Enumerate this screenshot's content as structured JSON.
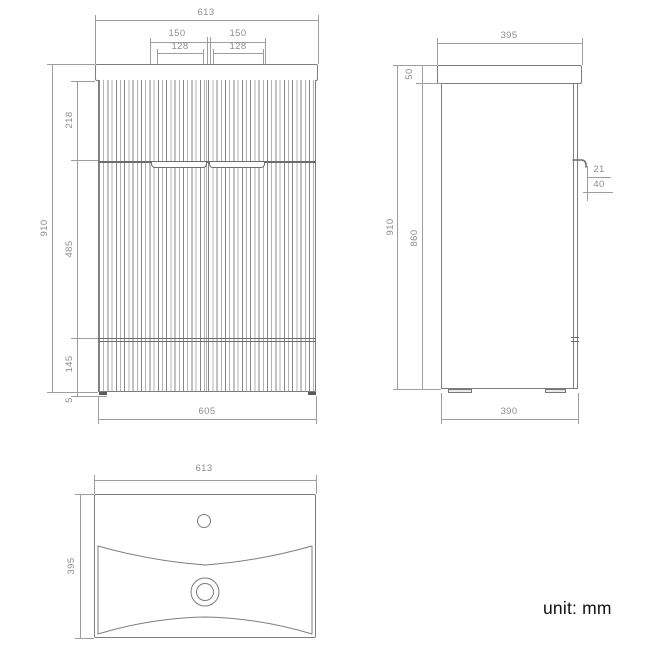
{
  "note": {
    "unit_label": "unit: mm"
  },
  "front_view": {
    "dims": {
      "overall_width": "613",
      "handle_span_left": "150",
      "handle_span_right": "150",
      "handle_width_left": "128",
      "handle_width_right": "128",
      "overall_height": "910",
      "top_section_height": "218",
      "middle_section_height": "485",
      "bottom_section_height": "145",
      "foot_height": "5",
      "cabinet_width": "605"
    }
  },
  "side_view": {
    "dims": {
      "overall_depth": "395",
      "worktop_thickness": "50",
      "overall_height": "910",
      "cabinet_height": "860",
      "handle_recess_depth": "21",
      "handle_recess_height": "40",
      "cabinet_depth": "390"
    }
  },
  "top_view": {
    "dims": {
      "basin_width": "613",
      "basin_depth": "395"
    }
  },
  "colors": {
    "drawing_line": "#7d7d7d",
    "dimension_line": "#9e9e9e",
    "dimension_text": "#8d8d8d",
    "unit_text": "#111111"
  }
}
